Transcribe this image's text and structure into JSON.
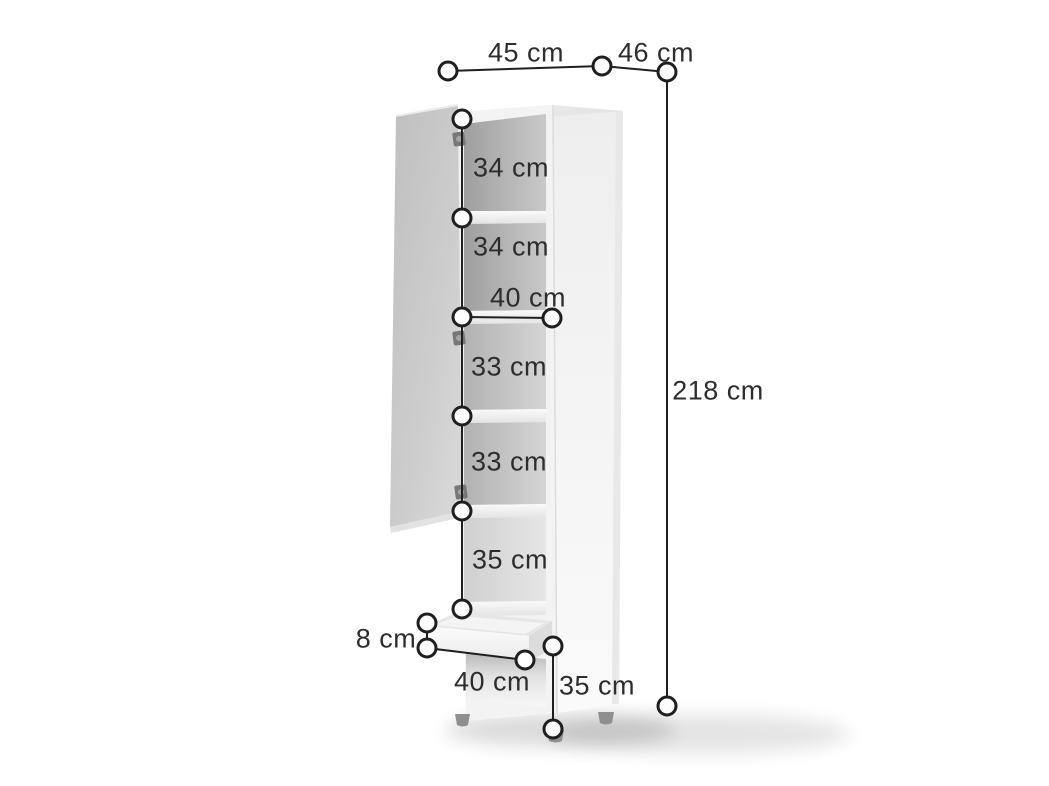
{
  "diagram": {
    "kind": "furniture-dimension-diagram",
    "subject": "tall cabinet with open door, five shelf compartments, drawer and open bottom compartment",
    "unit": "cm",
    "dimensions": {
      "top_width": {
        "value": 45,
        "label": "45 cm"
      },
      "top_depth": {
        "value": 46,
        "label": "46 cm"
      },
      "total_height": {
        "value": 218,
        "label": "218 cm"
      },
      "compartment_1_height": {
        "value": 34,
        "label": "34 cm"
      },
      "compartment_2_height": {
        "value": 34,
        "label": "34 cm"
      },
      "interior_width": {
        "value": 40,
        "label": "40 cm"
      },
      "compartment_3_height": {
        "value": 33,
        "label": "33 cm"
      },
      "compartment_4_height": {
        "value": 33,
        "label": "33 cm"
      },
      "compartment_5_height": {
        "value": 35,
        "label": "35 cm"
      },
      "drawer_height": {
        "value": 8,
        "label": "8 cm"
      },
      "drawer_width": {
        "value": 40,
        "label": "40 cm"
      },
      "bottom_compartment_height": {
        "value": 35,
        "label": "35 cm"
      }
    },
    "colors": {
      "background": "#ffffff",
      "dimension_line": "#1f1f1f",
      "marker_fill": "#ffffff",
      "text": "#2d2d2d",
      "cabinet_frame": "#f3f3f3",
      "cabinet_side": "#f4f4f4",
      "door": "#c8c8c8",
      "interior_dark": "#a5a5a5",
      "feet": "#8f8f8f"
    }
  }
}
